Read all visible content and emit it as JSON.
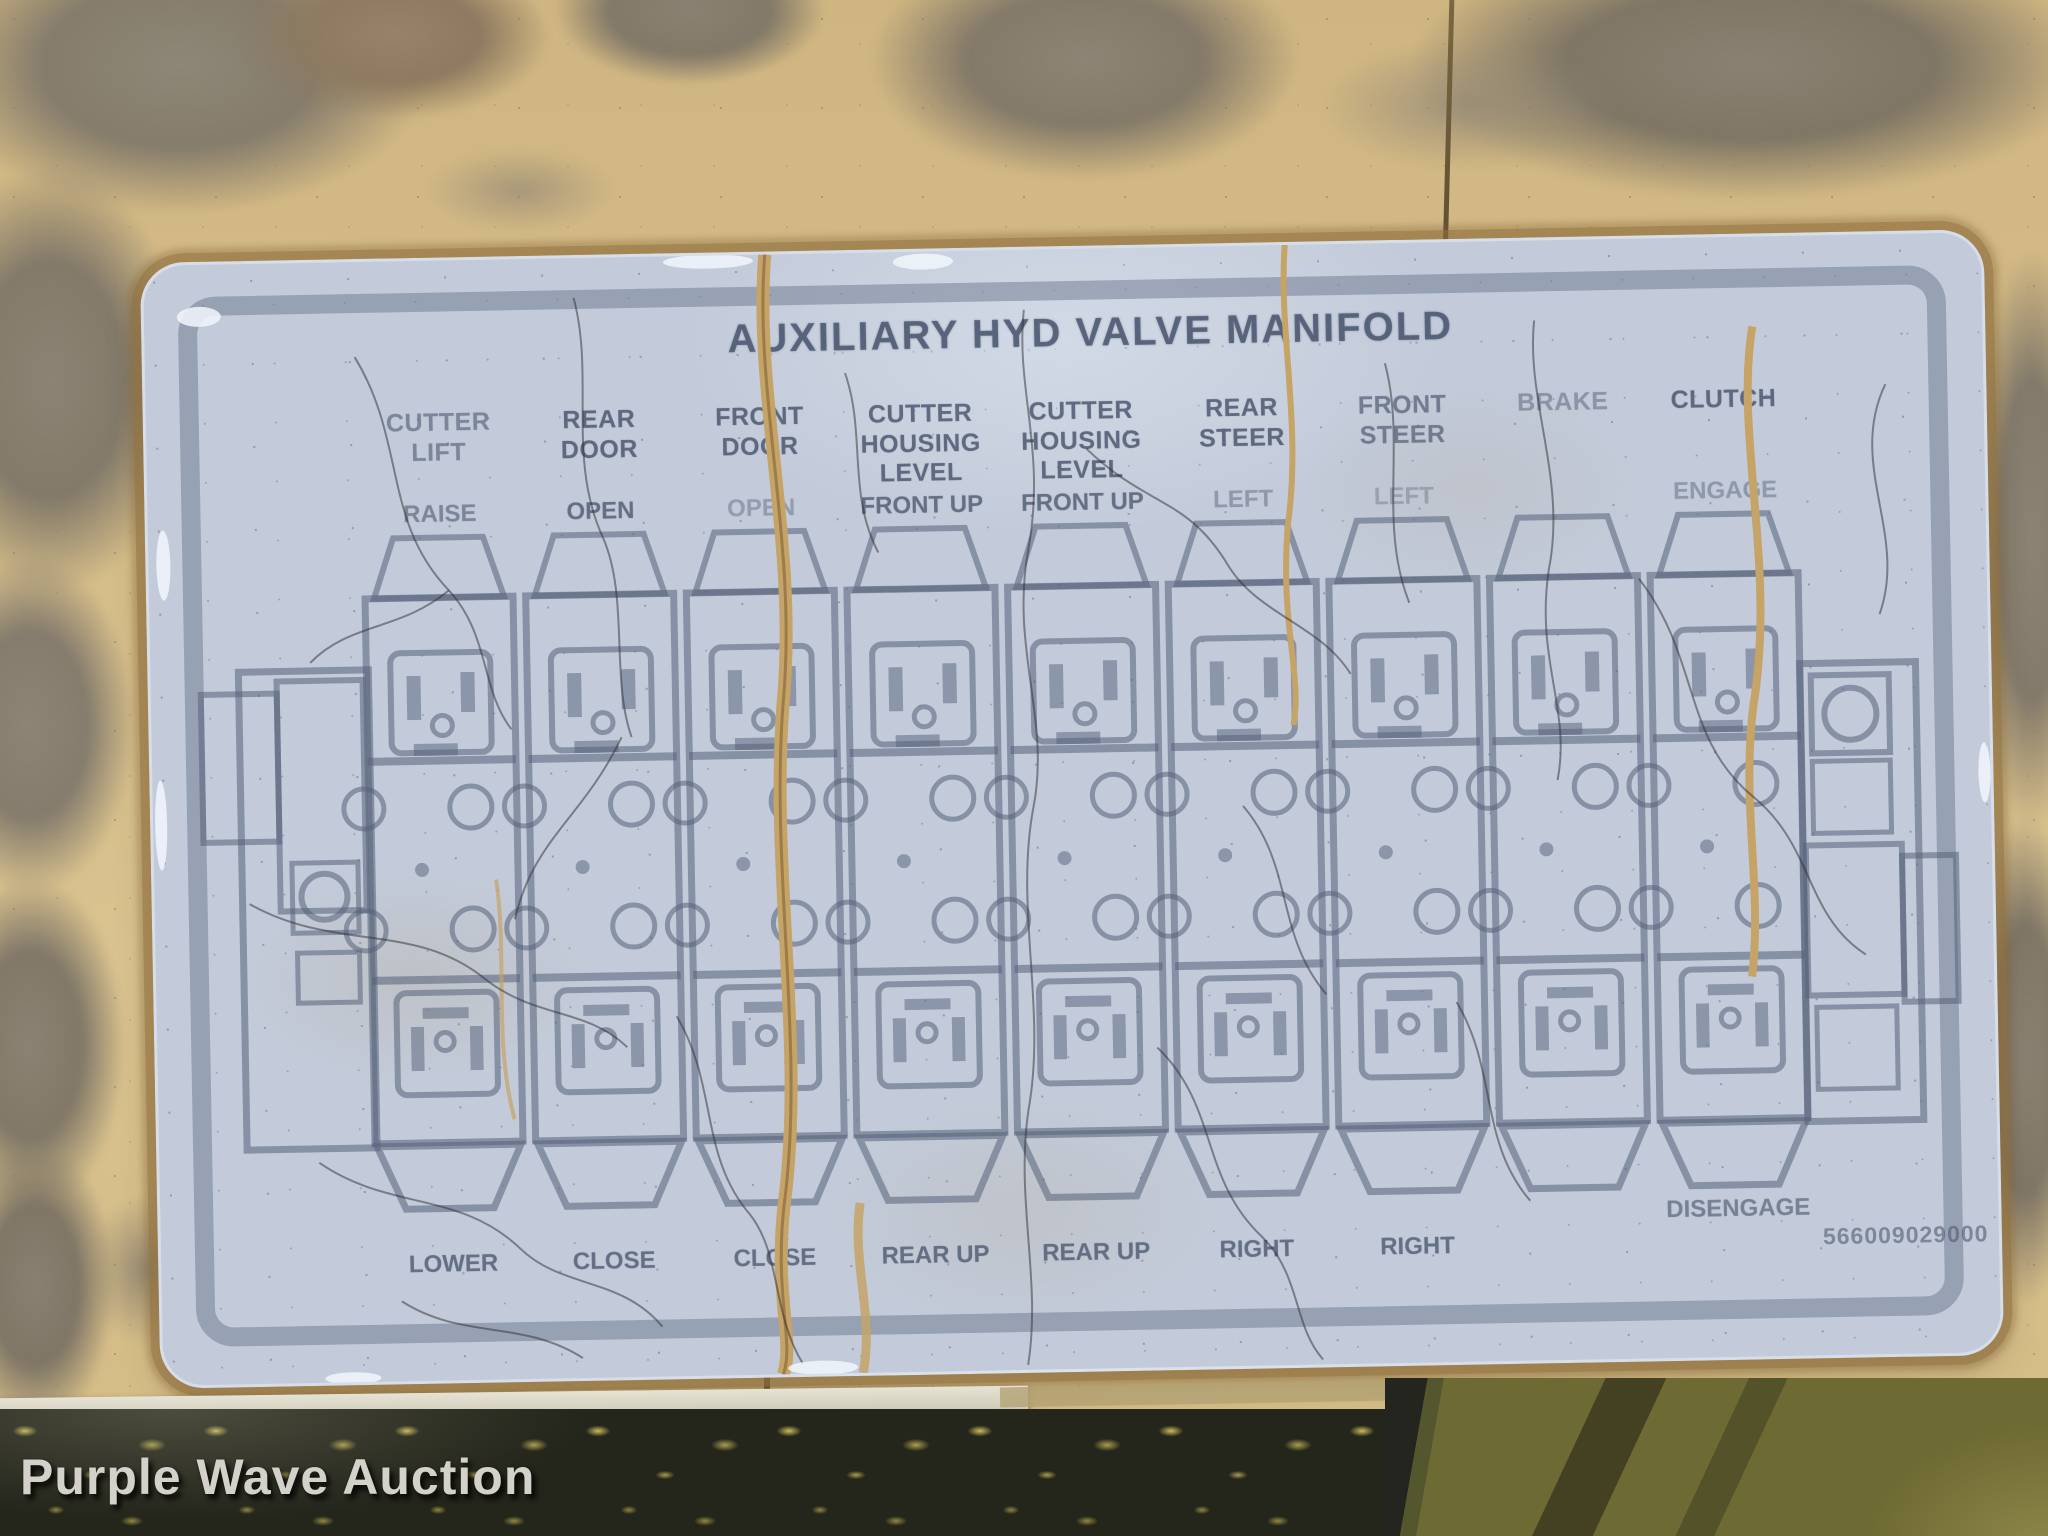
{
  "photo": {
    "watermark": "Purple Wave Auction"
  },
  "colors": {
    "ink": "#56627a",
    "decal_base": "#c3cbda",
    "decal_border": "#6c788e",
    "panel_paint": "#d5bc88",
    "rust_gray": "#8b8274",
    "crack_tan": "#c6a366"
  },
  "decal": {
    "title": "AUXILIARY HYD VALVE MANIFOLD",
    "part_number": "566009029000",
    "sections": [
      {
        "header": [
          "CUTTER",
          "LIFT"
        ],
        "action_up": "RAISE",
        "action_down": "LOWER"
      },
      {
        "header": [
          "REAR",
          "DOOR"
        ],
        "action_up": "OPEN",
        "action_down": "CLOSE"
      },
      {
        "header": [
          "FRONT",
          "DOOR"
        ],
        "action_up": "OPEN",
        "action_down": "CLOSE"
      },
      {
        "header": [
          "CUTTER",
          "HOUSING",
          "LEVEL"
        ],
        "action_up": "FRONT UP",
        "action_down": "REAR UP"
      },
      {
        "header": [
          "CUTTER",
          "HOUSING",
          "LEVEL"
        ],
        "action_up": "FRONT UP",
        "action_down": "REAR UP"
      },
      {
        "header": [
          "REAR",
          "STEER"
        ],
        "action_up": "LEFT",
        "action_down": "RIGHT"
      },
      {
        "header": [
          "FRONT",
          "STEER"
        ],
        "action_up": "LEFT",
        "action_down": "RIGHT"
      },
      {
        "header": [
          "BRAKE"
        ],
        "action_up": "",
        "action_down": ""
      },
      {
        "header": [
          "CLUTCH"
        ],
        "action_up": "ENGAGE",
        "action_down": "DISENGAGE"
      }
    ]
  }
}
